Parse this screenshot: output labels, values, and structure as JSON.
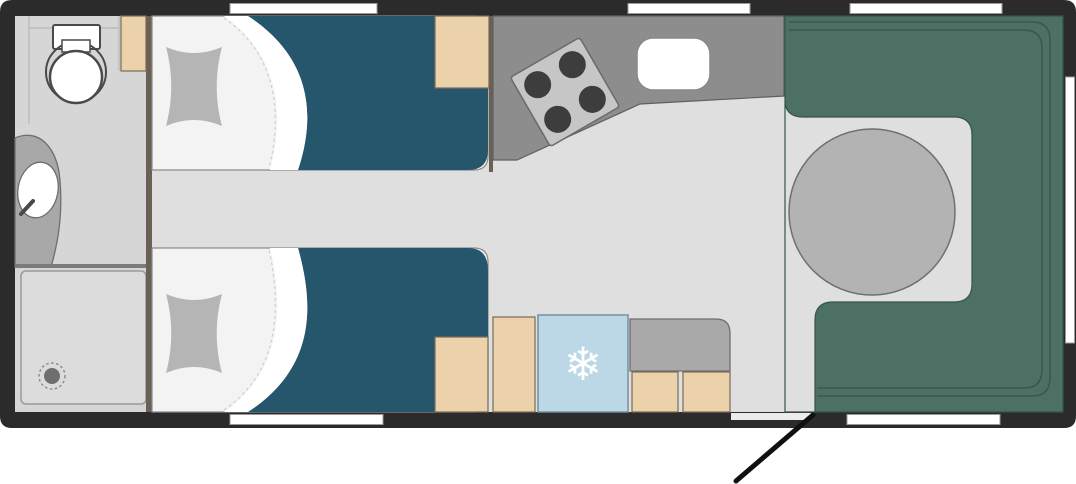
{
  "meta": {
    "title": "Caravan twin-bed floor plan",
    "view": "top-down schematic"
  },
  "icons": {
    "snowflake": "❄"
  },
  "colors": {
    "background": "#ffffff",
    "wall": "#2b2b2b",
    "floor": "#dfdfdf",
    "bathroom_floor": "#d6d6d6",
    "partition": "#6a6055",
    "bed_base": "#f3f3f3",
    "fold_white": "#ffffff",
    "pillow": "#b5b5b5",
    "duvet": "#25566c",
    "cabinet": "#ecd2ab",
    "counter": "#8d8d8d",
    "counter_low": "#a9a9a9",
    "stove": "#c6c6c6",
    "burner": "#3d3d3d",
    "sink": "#ffffff",
    "fridge": "#bcd7e6",
    "sofa": "#4d7065",
    "sofa_line": "#35544b",
    "table": "#b3b3b3",
    "shower": "#dcdcdc",
    "drain": "#6f6f6f",
    "vanity": "#a8a8a8",
    "divider": "#7b7b7b",
    "window": "#ffffff",
    "threshold": "#ececec",
    "door_line": "#101010"
  },
  "elements": {
    "rooms": [
      "washroom with toilet, vanity sink and shower",
      "twin single beds with pillows and duvets",
      "corner kitchen with hob, sink and fridge",
      "rear U-shaped lounge with round table"
    ],
    "furniture": [
      "toilet",
      "vanity-sink",
      "shower-tray",
      "bed-top",
      "bed-bottom",
      "wardrobe-cabinets",
      "kitchen-counter",
      "hob-4-burner",
      "kitchen-sink",
      "fridge",
      "lounge-sofa",
      "round-table",
      "entry-door"
    ],
    "windows": [
      "top-bedroom",
      "top-kitchen",
      "top-lounge",
      "bottom-bedroom",
      "bottom-lounge",
      "right-lounge"
    ]
  }
}
